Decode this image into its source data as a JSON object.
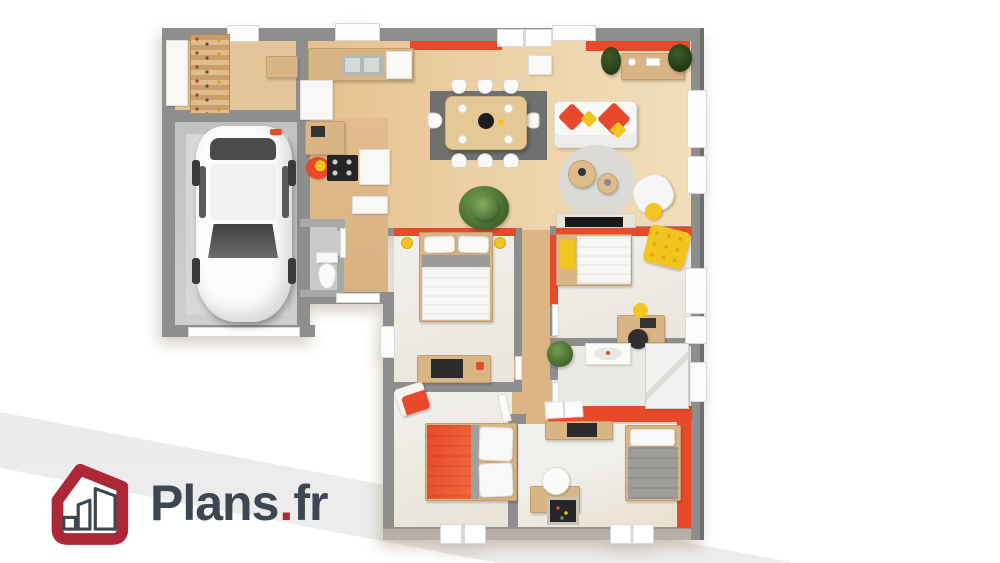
{
  "poster": {
    "type": "3d-floorplan-render",
    "background": "#ffffff"
  },
  "logo": {
    "brand": "Plans",
    "separator": ".",
    "tld": "fr",
    "icon": "house-outline-icon"
  },
  "colors": {
    "background": "#ffffff",
    "band-gray": "#ececec",
    "wall": "#8e8e8e",
    "wall-outer": "#6f6f6f",
    "wall-bottom-face": "#b7aea6",
    "accent-red": "#e8492b",
    "accent-yellow": "#f2c41d",
    "wood-floor": "#e6bf8d",
    "wood-floor-light": "#f2debc",
    "wood-hall": "#dcb584",
    "wood-furniture": "#d9b586",
    "floor-white": "#f0efeb",
    "floor-bath": "#ebe9e4",
    "garage-floor": "#c8c7c5",
    "rug-dark": "#70706e",
    "rug-light": "#dbdad6",
    "plant-green": "#4e7136",
    "logo-red": "#ae2737",
    "logo-dark": "#3d4651"
  },
  "plan": {
    "rooms": [
      "garage",
      "storage-cellar",
      "kitchen",
      "dining-area",
      "living-room",
      "entry-hall",
      "wc",
      "hallway",
      "bedroom-1",
      "bedroom-2",
      "bathroom",
      "bedroom-3",
      "bedroom-4"
    ],
    "furniture": [
      "white-car",
      "storage-shelves",
      "kitchen-counter-sink",
      "cooktop",
      "fridge",
      "desk-nook",
      "dining-table-8-chairs",
      "white-sofa-red-yellow-pillows",
      "sideboard-plants",
      "round-rug",
      "coffee-tables",
      "armchair",
      "tv",
      "double-bed-white",
      "single-bed-yellow-pillow",
      "yellow-rug",
      "kids-desk",
      "washbasin",
      "shower",
      "toilet",
      "double-bed-red",
      "gray-bed",
      "small-desk-round-chair"
    ]
  }
}
